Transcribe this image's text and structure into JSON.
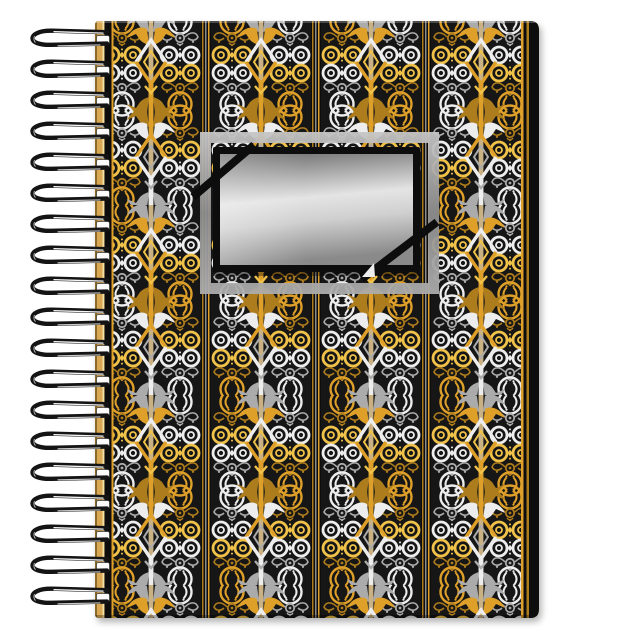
{
  "scene": {
    "background": "#ffffff",
    "description": "Product photo of a spiral-bound notebook with a black, gold and silver ornamental pattern cover and a blank metallic silver label plate"
  },
  "product": {
    "name": "spiral notebook",
    "cover_style": "black cover with vertical ornamental columns: gold and silver circle medallions, ring pairs, filigree garlands, axe blades and large diamond outlines on striped poles",
    "label_plate": "blank rectangular silver-gradient plate with black border, gray metal outer frame and black diagonal corner straps",
    "orientation": "portrait"
  },
  "binding": {
    "side": "left",
    "loops": 19,
    "first_y": 40,
    "spacing": 31
  },
  "colors": {
    "page-bg": "#ffffff",
    "cover-bg": "#131313",
    "separator-bg": "#0e0e0e",
    "gold": "#DFA02A",
    "gold-bright": "#F0C24A",
    "gold-dim": "#AD7B1E",
    "silver": "#EDEDED",
    "silver-dim": "#ABABAB",
    "gray": "#8D8D8D",
    "tan": "#C9B183",
    "wire": "#141414",
    "hole": "#fbfbfb",
    "plate-border": "#0D0D0D",
    "plate-light": "#E4E4E4",
    "plate-mid": "#9A9A9A",
    "plate-dark": "#6B6B6B",
    "frame-light": "#C6C6C6",
    "frame-dark": "#8E8E8E",
    "edge-tan": "#D9A855",
    "edge-highlight": "#F2E2A8"
  }
}
